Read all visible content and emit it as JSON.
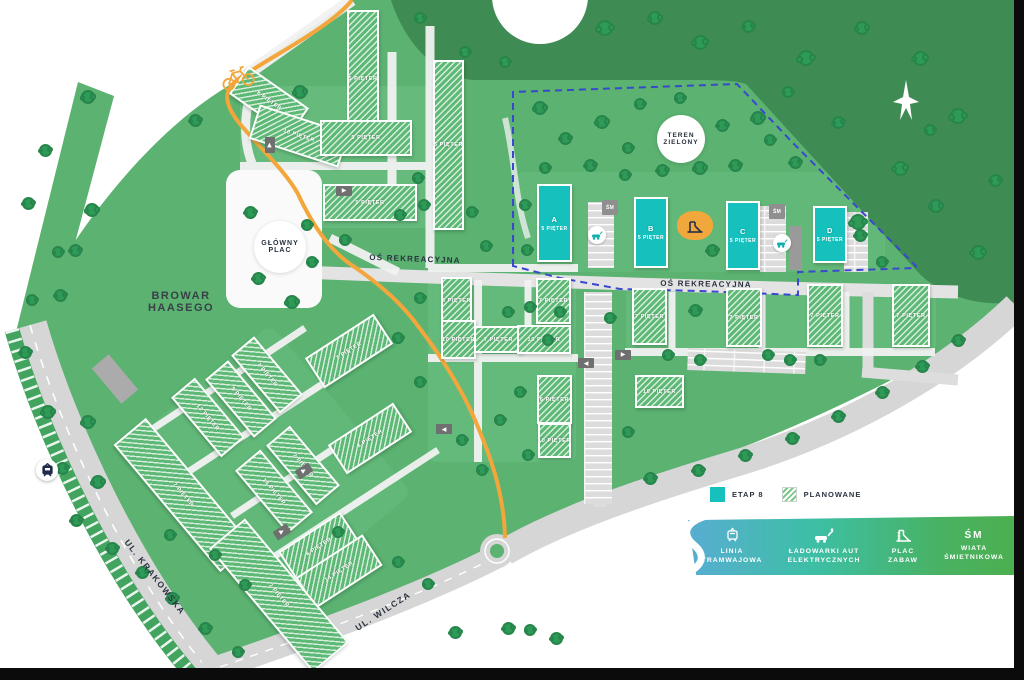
{
  "areas": {
    "teren_zielony": {
      "lines": [
        "TEREN",
        "ZIELONY"
      ]
    },
    "glowny_plac": {
      "lines": [
        "GŁÓWNY",
        "PLAC"
      ]
    },
    "browar": {
      "lines": [
        "BROWAR",
        "HAASEGO"
      ]
    }
  },
  "streets": [
    {
      "id": "os-rekreacyjna-west",
      "name": "OŚ REKREACYJNA",
      "x": 415,
      "y": 259,
      "rot": 2,
      "size": 8
    },
    {
      "id": "os-rekreacyjna-east",
      "name": "OŚ REKREACYJNA",
      "x": 706,
      "y": 284,
      "rot": 1,
      "size": 8
    },
    {
      "id": "ul-krakowska",
      "name": "UL. KRAKOWSKA",
      "x": 155,
      "y": 577,
      "rot": 52,
      "size": 8.5
    },
    {
      "id": "ul-wilcza",
      "name": "UL. WILCZA",
      "x": 383,
      "y": 611,
      "rot": -33,
      "size": 8.5
    }
  ],
  "sm_label": "ŚM",
  "buildings": [
    {
      "label": "5 PIĘTER",
      "x": 347,
      "y": 10,
      "w": 32,
      "h": 138,
      "rot": 0
    },
    {
      "label": "8 PIĘTER",
      "x": 232,
      "y": 84,
      "w": 74,
      "h": 34,
      "rot": 35
    },
    {
      "label": "10 PIĘTER",
      "x": 252,
      "y": 118,
      "w": 94,
      "h": 36,
      "rot": 18
    },
    {
      "label": "5 PIĘTER",
      "x": 320,
      "y": 120,
      "w": 92,
      "h": 36,
      "rot": 0
    },
    {
      "label": "5 PIĘTER",
      "x": 433,
      "y": 60,
      "w": 31,
      "h": 170,
      "rot": 0
    },
    {
      "label": "5 PIĘTER",
      "x": 323,
      "y": 184,
      "w": 94,
      "h": 37,
      "rot": 0
    },
    {
      "label": "8 PIĘTER",
      "x": 441,
      "y": 277,
      "w": 31,
      "h": 47,
      "rot": 0
    },
    {
      "label": "10 PIĘTER",
      "x": 441,
      "y": 320,
      "w": 35,
      "h": 39,
      "rot": 0
    },
    {
      "label": "7 PIĘTER",
      "x": 474,
      "y": 326,
      "w": 49,
      "h": 27,
      "rot": 0
    },
    {
      "label": "7 PIĘTER",
      "x": 536,
      "y": 278,
      "w": 35,
      "h": 46,
      "rot": 0
    },
    {
      "label": "10 PIĘTER",
      "x": 517,
      "y": 325,
      "w": 54,
      "h": 29,
      "rot": 0
    },
    {
      "label": "6 PIĘTER",
      "x": 537,
      "y": 375,
      "w": 35,
      "h": 49,
      "rot": 0
    },
    {
      "label": "10 PIĘTER",
      "x": 538,
      "y": 423,
      "w": 33,
      "h": 35,
      "rot": 0
    },
    {
      "label": "7 PIĘTER",
      "x": 632,
      "y": 288,
      "w": 35,
      "h": 57,
      "rot": 0
    },
    {
      "label": "7 PIĘTER",
      "x": 726,
      "y": 288,
      "w": 36,
      "h": 59,
      "rot": 0
    },
    {
      "label": "7 PIĘTER",
      "x": 807,
      "y": 284,
      "w": 36,
      "h": 63,
      "rot": 0
    },
    {
      "label": "7 PIĘTER",
      "x": 892,
      "y": 284,
      "w": 38,
      "h": 63,
      "rot": 0
    },
    {
      "label": "10 PIĘTER",
      "x": 635,
      "y": 375,
      "w": 49,
      "h": 33,
      "rot": 0
    },
    {
      "label": "7 PIĘTER",
      "x": 308,
      "y": 333,
      "w": 82,
      "h": 36,
      "rot": -33
    },
    {
      "label": "7 PIĘTER",
      "x": 229,
      "y": 360,
      "w": 76,
      "h": 30,
      "rot": 50
    },
    {
      "label": "8 PIĘTER",
      "x": 203,
      "y": 384,
      "w": 76,
      "h": 30,
      "rot": 50
    },
    {
      "label": "12 PIĘTER",
      "x": 169,
      "y": 402,
      "w": 78,
      "h": 31,
      "rot": 50
    },
    {
      "label": "8 PIĘTER",
      "x": 331,
      "y": 421,
      "w": 78,
      "h": 35,
      "rot": -33
    },
    {
      "label": "7 PIĘTER",
      "x": 264,
      "y": 450,
      "w": 78,
      "h": 31,
      "rot": 50
    },
    {
      "label": "14 PIĘTER",
      "x": 233,
      "y": 475,
      "w": 82,
      "h": 33,
      "rot": 50
    },
    {
      "label": "7 PIĘTER",
      "x": 100,
      "y": 474,
      "w": 166,
      "h": 42,
      "rot": 50
    },
    {
      "label": "8 PIĘTER",
      "x": 282,
      "y": 529,
      "w": 74,
      "h": 36,
      "rot": -33
    },
    {
      "label": "14 PIĘTER",
      "x": 299,
      "y": 553,
      "w": 80,
      "h": 37,
      "rot": -33
    },
    {
      "label": "7 PIĘTER",
      "x": 198,
      "y": 572,
      "w": 162,
      "h": 47,
      "rot": 50
    }
  ],
  "etap8_buildings": [
    {
      "letter": "A",
      "floors": "5 PIĘTER",
      "x": 537,
      "y": 184,
      "w": 35,
      "h": 78
    },
    {
      "letter": "B",
      "floors": "5 PIĘTER",
      "x": 634,
      "y": 197,
      "w": 34,
      "h": 71
    },
    {
      "letter": "C",
      "floors": "5 PIĘTER",
      "x": 726,
      "y": 201,
      "w": 34,
      "h": 69
    },
    {
      "letter": "D",
      "floors": "5 PIĘTER",
      "x": 813,
      "y": 206,
      "w": 34,
      "h": 57
    }
  ],
  "legend": {
    "etap8_label": "ETAP 8",
    "planowane_label": "PLANOWANE",
    "colors": {
      "etap8": "#15C0BD",
      "planned_hatch": "#7CC68E",
      "bar_gradient": [
        "#58ADD1",
        "#3DBFA6",
        "#4CAF50"
      ],
      "bike_path": "#F2A63B",
      "boundary_dashed": "#3A47CF"
    },
    "items": [
      {
        "icon": "tram-icon",
        "lines": [
          "LINIA",
          "TRAMWAJOWA"
        ]
      },
      {
        "icon": "ev-charger-icon",
        "lines": [
          "ŁADOWARKI AUT",
          "ELEKTRYCZNYCH"
        ]
      },
      {
        "icon": "slide-icon",
        "lines": [
          "PLAC",
          "ZABAW"
        ]
      },
      {
        "icon": "sm-text-icon",
        "sm": "ŚM",
        "lines": [
          "WIATA",
          "ŚMIETNIKOWA"
        ]
      }
    ]
  }
}
